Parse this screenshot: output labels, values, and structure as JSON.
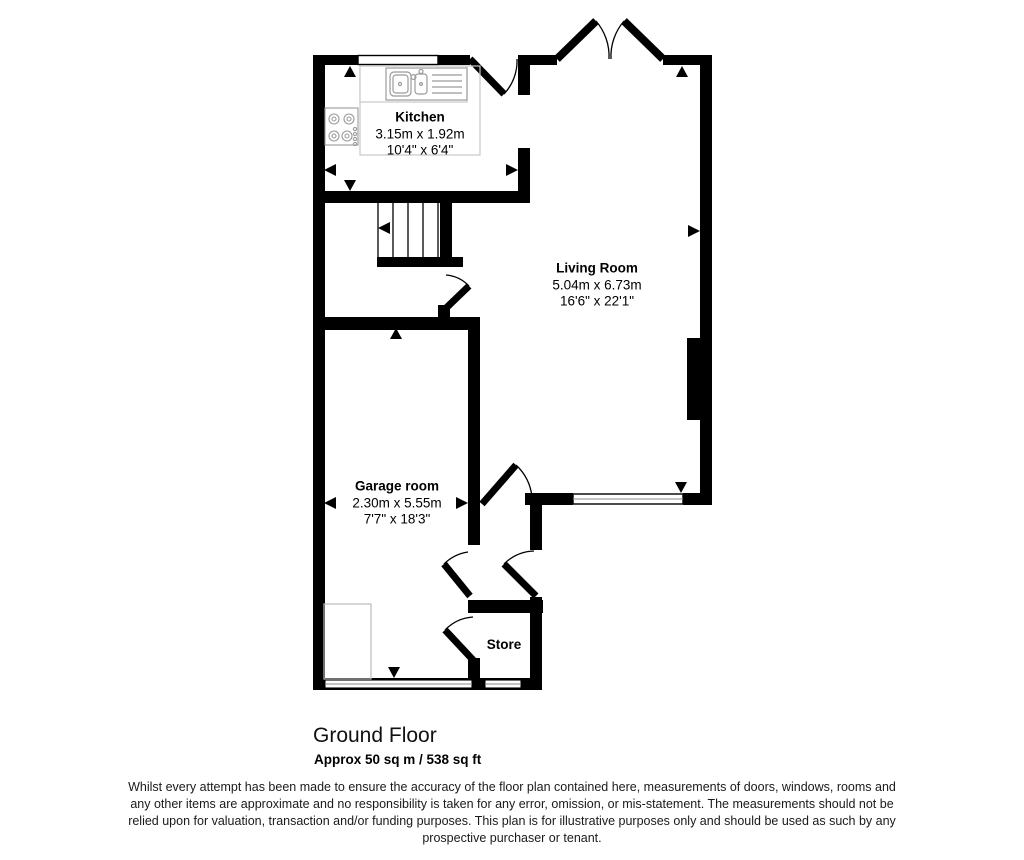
{
  "plan": {
    "rooms": {
      "kitchen": {
        "name": "Kitchen",
        "metric": "3.15m x 1.92m",
        "imperial": "10'4\" x 6'4\""
      },
      "living_room": {
        "name": "Living Room",
        "metric": "5.04m x 6.73m",
        "imperial": "16'6\" x 22'1\""
      },
      "garage": {
        "name": "Garage room",
        "metric": "2.30m x 5.55m",
        "imperial": "7'7\" x 18'3\""
      },
      "store": {
        "name": "Store"
      }
    },
    "colors": {
      "wall": "#000000",
      "fixture_outline": "#9b9b9b",
      "counter_outline": "#c9c9c9",
      "background": "#ffffff"
    }
  },
  "footer": {
    "floor_label": "Ground Floor",
    "area_label": "Approx 50 sq m / 538 sq ft",
    "disclaimer": "Whilst every attempt has been made to ensure the accuracy of the floor plan contained here, measurements of doors, windows, rooms and any other items are approximate and no responsibility is taken for any error, omission, or mis-statement. The measurements should not be relied upon for valuation, transaction and/or funding purposes. This plan is for illustrative purposes only and should be used as such by any prospective purchaser or tenant."
  }
}
